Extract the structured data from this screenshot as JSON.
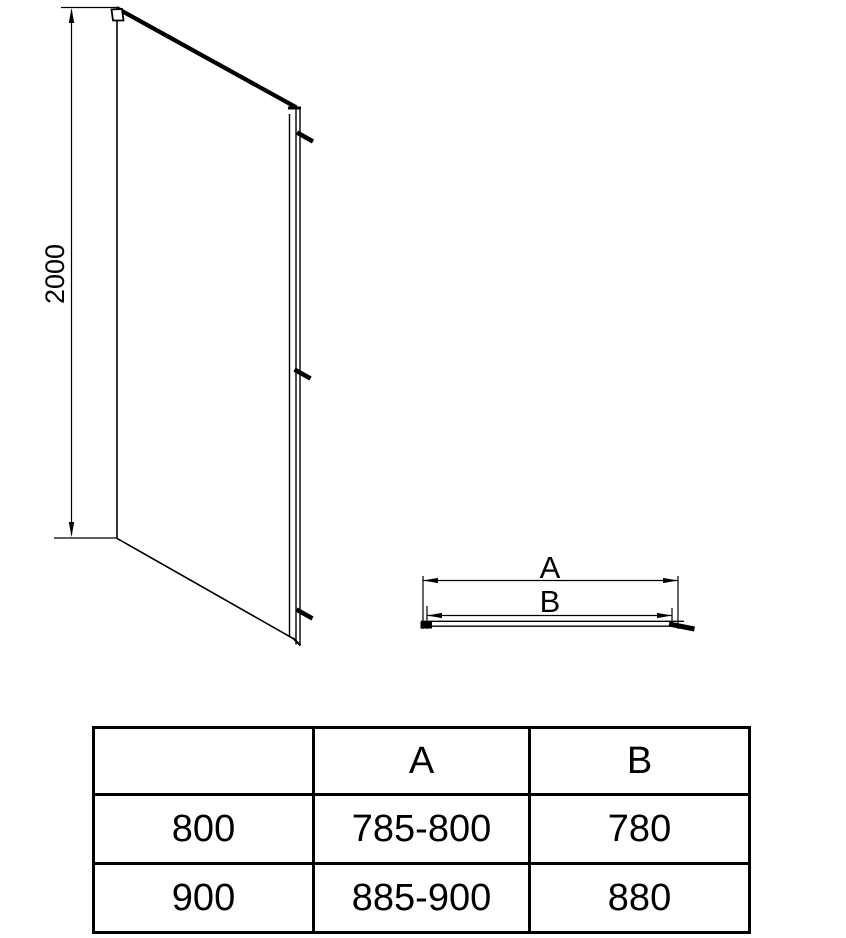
{
  "drawing": {
    "height_label": "2000",
    "plan": {
      "a_label": "A",
      "b_label": "B"
    }
  },
  "table": {
    "headers": {
      "size": "",
      "a": "A",
      "b": "B"
    },
    "rows": [
      {
        "size": "800",
        "a": "785-800",
        "b": "780"
      },
      {
        "size": "900",
        "a": "885-900",
        "b": "880"
      }
    ]
  },
  "colors": {
    "line": "#000000",
    "background": "#ffffff"
  }
}
